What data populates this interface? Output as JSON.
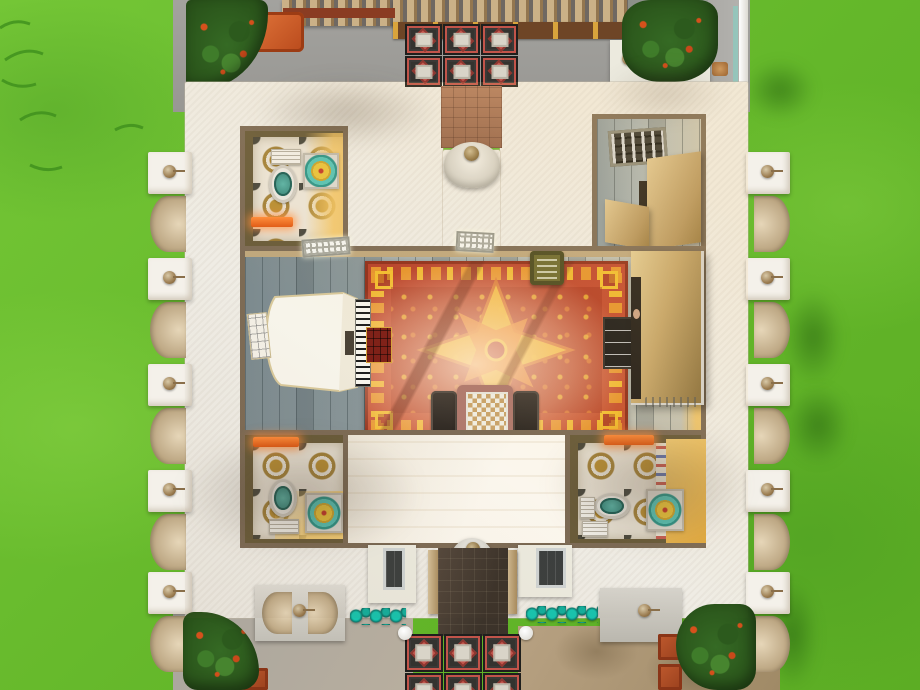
{
  "scene": {
    "description": "overhead-view-of-white-mansion-interior",
    "colors": {
      "grass": "#68bb2d",
      "concrete_path": "#9e9d99",
      "building_white": "#efece4",
      "interior_wall": "#7d6b55",
      "wood_floor": "#9fa9ab",
      "carpet_red": "#b6402a",
      "carpet_yellow": "#f1bd2e",
      "carpet_orange": "#e8982c",
      "tile_cream": "#ebe4d6",
      "tile_gold": "#b98f35",
      "tile_dark": "#4a4a42",
      "walkway_tile_dark": "#34332f",
      "walkway_tile_red": "#c4574e",
      "teal_water": "#2e9488",
      "towel_orange": "#ff8c3a",
      "pergola_tan": "#cbb187",
      "brick_path": "#a06d53",
      "murphy_bed_tan": "#c4a468"
    },
    "rooms": [
      {
        "id": "music-room",
        "objects": [
          "grand-piano",
          "piano-bench",
          "area-rug",
          "ottoman",
          "chess-table",
          "chairs",
          "typewriter-table",
          "bookshelf",
          "murphy-bed",
          "ceiling-lights"
        ]
      },
      {
        "id": "bathroom-top-left",
        "objects": [
          "toilet",
          "shower",
          "towel-rack",
          "cistern"
        ]
      },
      {
        "id": "closet-top-right",
        "objects": [
          "solar-panel",
          "wardrobe-doors"
        ]
      },
      {
        "id": "bathroom-bottom-left",
        "objects": [
          "toilet",
          "shower",
          "towel-rack"
        ]
      },
      {
        "id": "bathroom-bottom-right",
        "objects": [
          "toilet",
          "shower",
          "sink",
          "towel-rack",
          "patterned-wallpaper"
        ]
      },
      {
        "id": "entry-hall-bottom",
        "objects": [
          "wall-fountain"
        ]
      }
    ],
    "outdoor_features": [
      "pergola",
      "flowering-bushes",
      "tree",
      "ornate-walkway-tiles",
      "brick-path",
      "dark-exit-path",
      "teal-flowerbeds",
      "statue-pilasters",
      "wall-fountains",
      "orange-garden-bench",
      "terracotta-planters",
      "white-fence"
    ],
    "repeats": {
      "entry_tiles": {
        "cols": 3,
        "rows": 2,
        "x": 405,
        "y": 24,
        "w": 38,
        "h": 32
      },
      "exit_tiles": {
        "cols": 3,
        "rows": 2,
        "x": 405,
        "y": 634,
        "w": 39,
        "h": 39
      },
      "pilasters_left_y": [
        152,
        258,
        364,
        470,
        572
      ],
      "pilasters_right_y": [
        152,
        258,
        364,
        470,
        572
      ]
    }
  }
}
